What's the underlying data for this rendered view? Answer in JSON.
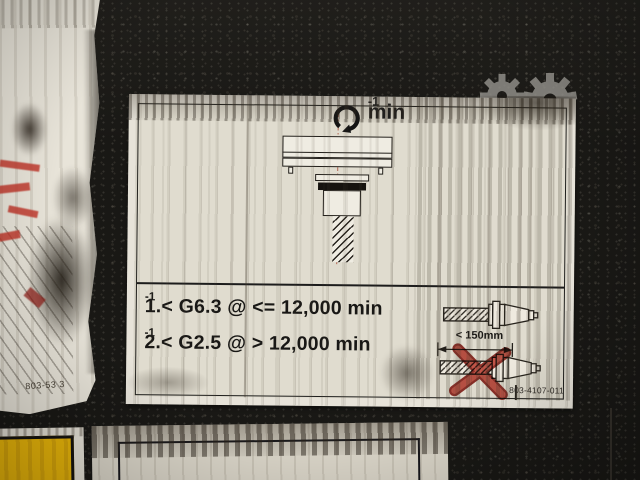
{
  "main_label": {
    "unit": {
      "base": "min",
      "sup": "-1"
    },
    "rules": [
      {
        "text": "1.< G6.3 @ <= 12,000 min",
        "sup": "-1"
      },
      {
        "text": "2.< G2.5 @ > 12,000 min",
        "sup": "-1"
      }
    ],
    "dimension_label": "< 150mm",
    "part_number": "803-4107-011"
  },
  "left_label": {
    "part_number": "803-53 3"
  },
  "colors": {
    "surface": "#191815",
    "paper": "#e0dccf",
    "ink": "#1c1c1c",
    "centerline_red": "#a8503c",
    "prohibit_red": "#c03428",
    "yellow": "#edb90a",
    "watermark_gray": "#96948e"
  }
}
